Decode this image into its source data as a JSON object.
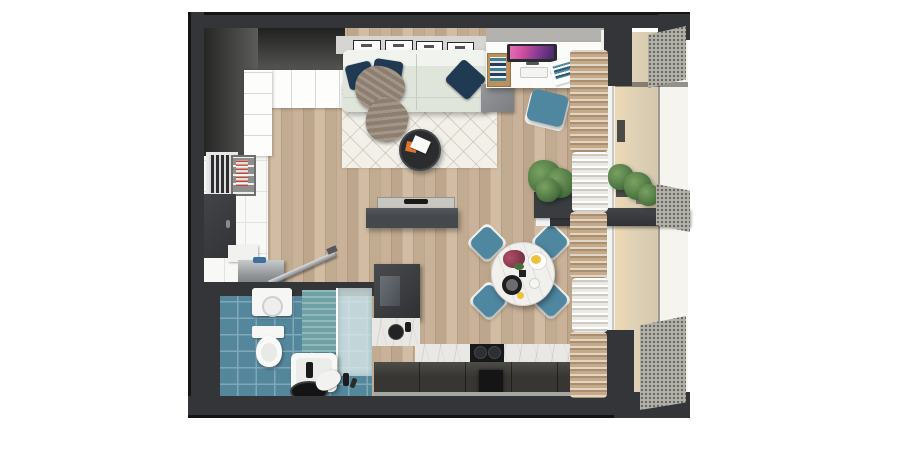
{
  "scene": {
    "type": "3d-floor-plan-top-down-render",
    "description": "Photorealistic top-down 3D render of a studio apartment floor plan with living area, kitchen, dining corner, bathroom, entry hall and a balcony on the right",
    "canvas": {
      "width": 900,
      "height": 450
    }
  },
  "palette": {
    "background": "#ffffff",
    "wallDark": "#333538",
    "wallEdge": "#141414",
    "wallFaceLight": "#d6d5d2",
    "wallFaceGray": "#b3b2af",
    "wood": "#c9b299",
    "woodDark": "#bda68c",
    "tile": "#f8f8f6",
    "rug": "#f2f0e9",
    "sofa": "#dfe5db",
    "pillow": "#1f3a52",
    "blanket": "#8d7e6f",
    "consoleDark": "#45484c",
    "tvPanel": "#c9c7c2",
    "desk": "#fbfbfa",
    "screenPink": "#cf4f9f",
    "screenPurple": "#47286b",
    "chairTeal": "#4f86a0",
    "marbleTable": "#f2f0ec",
    "counterMarble": "#eae8e4",
    "cabinetDark": "#3a3938",
    "hoodBlack": "#151515",
    "plantGreen": "#4a7440",
    "planterDark": "#3a3d40",
    "curtainBeige": "#c5aa8a",
    "curtainWhite": "#ece9e1",
    "balconyFloor": "#e6d8ba",
    "meshGray": "#b1b0a8",
    "bathBlue": "#55879c",
    "bathGrout": "#7fa9b8",
    "showerTeal": "#6fa0a4",
    "doormat": "#9aa0a3",
    "accentOrange": "#e0762f",
    "flowerPink": "#b04f66",
    "foodYellow": "#eec23d"
  },
  "rooms": [
    {
      "name": "living-room",
      "objects": [
        "corner-wardrobe",
        "wall-frames",
        "sofa",
        "navy-pillows",
        "throw-blanket",
        "geometric-rug",
        "round-coffee-table",
        "tv-sideboard",
        "flat-tv",
        "desk",
        "monitor",
        "keyboard",
        "mouse",
        "desk-organizer",
        "magazine",
        "desk-chair",
        "side-cabinet",
        "potted-plant"
      ],
      "wall_frame_count": 4,
      "pillow_count": 3
    },
    {
      "name": "dining-corner",
      "objects": [
        "round-marble-table",
        "teal-chairs",
        "flower-bouquet",
        "fruit-plate",
        "black-plate",
        "cup"
      ],
      "chair_count": 4
    },
    {
      "name": "kitchen",
      "objects": [
        "tall-cabinet",
        "marble-countertop",
        "cooktop",
        "extractor-hood",
        "base-cabinets",
        "kettle"
      ]
    },
    {
      "name": "entry-hall",
      "objects": [
        "entry-door",
        "dish-niche",
        "display-cabinet",
        "metal-shoe-bench",
        "leaning-rod"
      ]
    },
    {
      "name": "bathroom",
      "objects": [
        "washing-machine",
        "toilet",
        "bathtub",
        "shower-glass",
        "teal-tile-wall",
        "round-mirror",
        "toiletries"
      ]
    },
    {
      "name": "balcony",
      "objects": [
        "curtains",
        "window-wall",
        "balcony-plants",
        "perforated-railing-panels"
      ],
      "railing_panel_count": 3,
      "curtain_segment_count": 5
    }
  ]
}
